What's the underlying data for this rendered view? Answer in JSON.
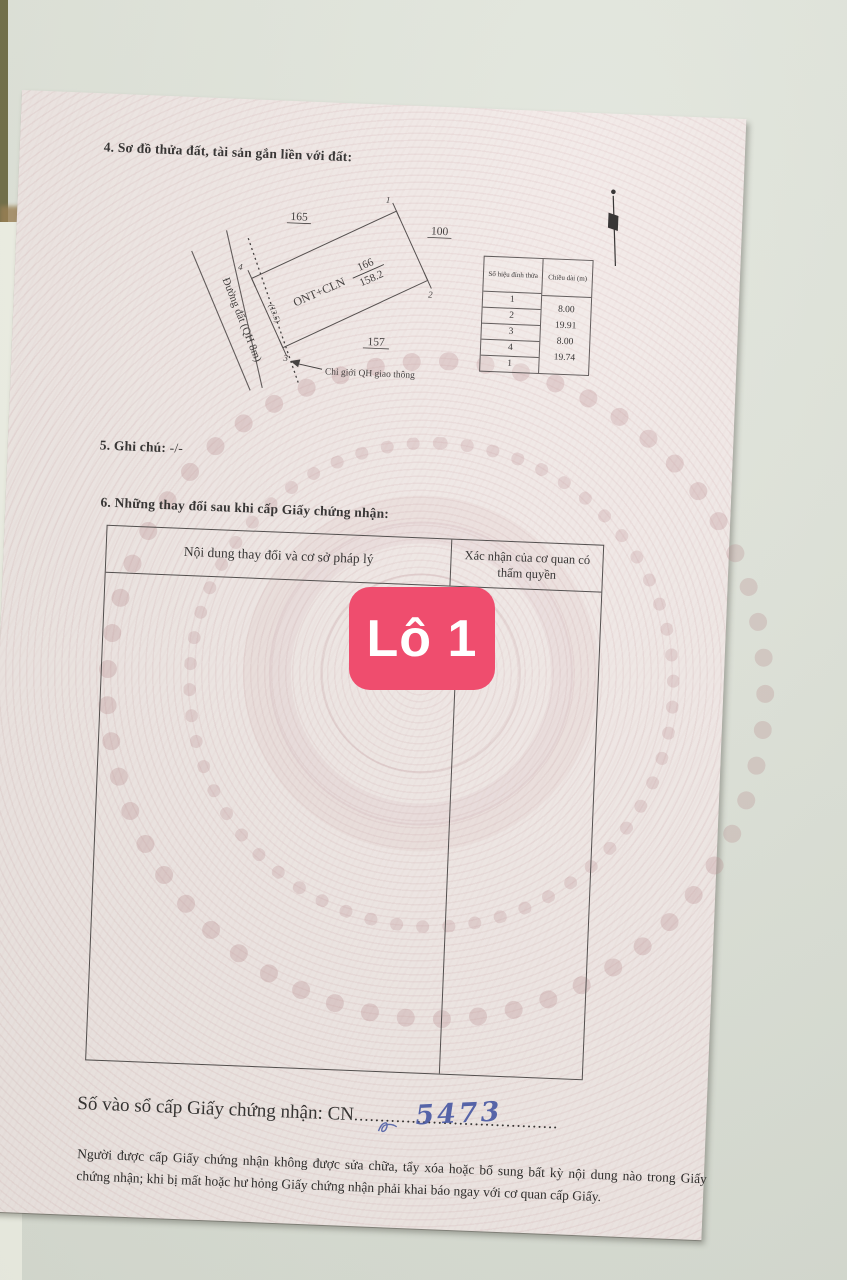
{
  "badge": {
    "label": "Lô 1"
  },
  "doc": {
    "s4_title": "4. Sơ đồ thửa đất, tài sản gắn liền với đất:",
    "diagram": {
      "neighbor_top": "165",
      "neighbor_right": "100",
      "neighbor_bottom": "157",
      "land_use": "ONT+CLN",
      "parcel_no": "166",
      "parcel_area": "158.2",
      "road": "Đường đất (QH 8m)",
      "offset": "(13.5)",
      "boundary": "Chỉ giới QH giao thông",
      "v1": "1",
      "v2": "2",
      "v3": "3",
      "v4": "4"
    },
    "vtable": {
      "h1": "Số hiệu đỉnh thửa",
      "h2": "Chiều dài (m)",
      "ids": [
        "1",
        "2",
        "3",
        "4",
        "1"
      ],
      "lengths": [
        "8.00",
        "19.91",
        "8.00",
        "19.74"
      ]
    },
    "s5_label": "5. Ghi chú:",
    "s5_value": "-/-",
    "s6_title": "6. Những thay đổi sau khi cấp Giấy chứng nhận:",
    "ctable": {
      "col1": "Nội dung thay đổi và cơ sở pháp lý",
      "col2": "Xác nhận của cơ quan có thẩm quyền"
    },
    "register": {
      "label": "Số vào sổ cấp Giấy chứng nhận:",
      "prefix": "CN",
      "number": "5473",
      "dots": "......................................."
    },
    "footer": "Người được cấp Giấy chứng nhận không được sửa chữa, tẩy xóa hoặc bổ sung bất kỳ nội dung nào trong Giấy chứng nhận; khi bị mất hoặc hư hỏng Giấy chứng nhận phải khai báo ngay với cơ quan cấp Giấy."
  },
  "colors": {
    "badge": "#ef4d6e",
    "paper": "#f2eae8",
    "handwriting_ink": "#3f51a5",
    "tile": "#dfe3da"
  }
}
